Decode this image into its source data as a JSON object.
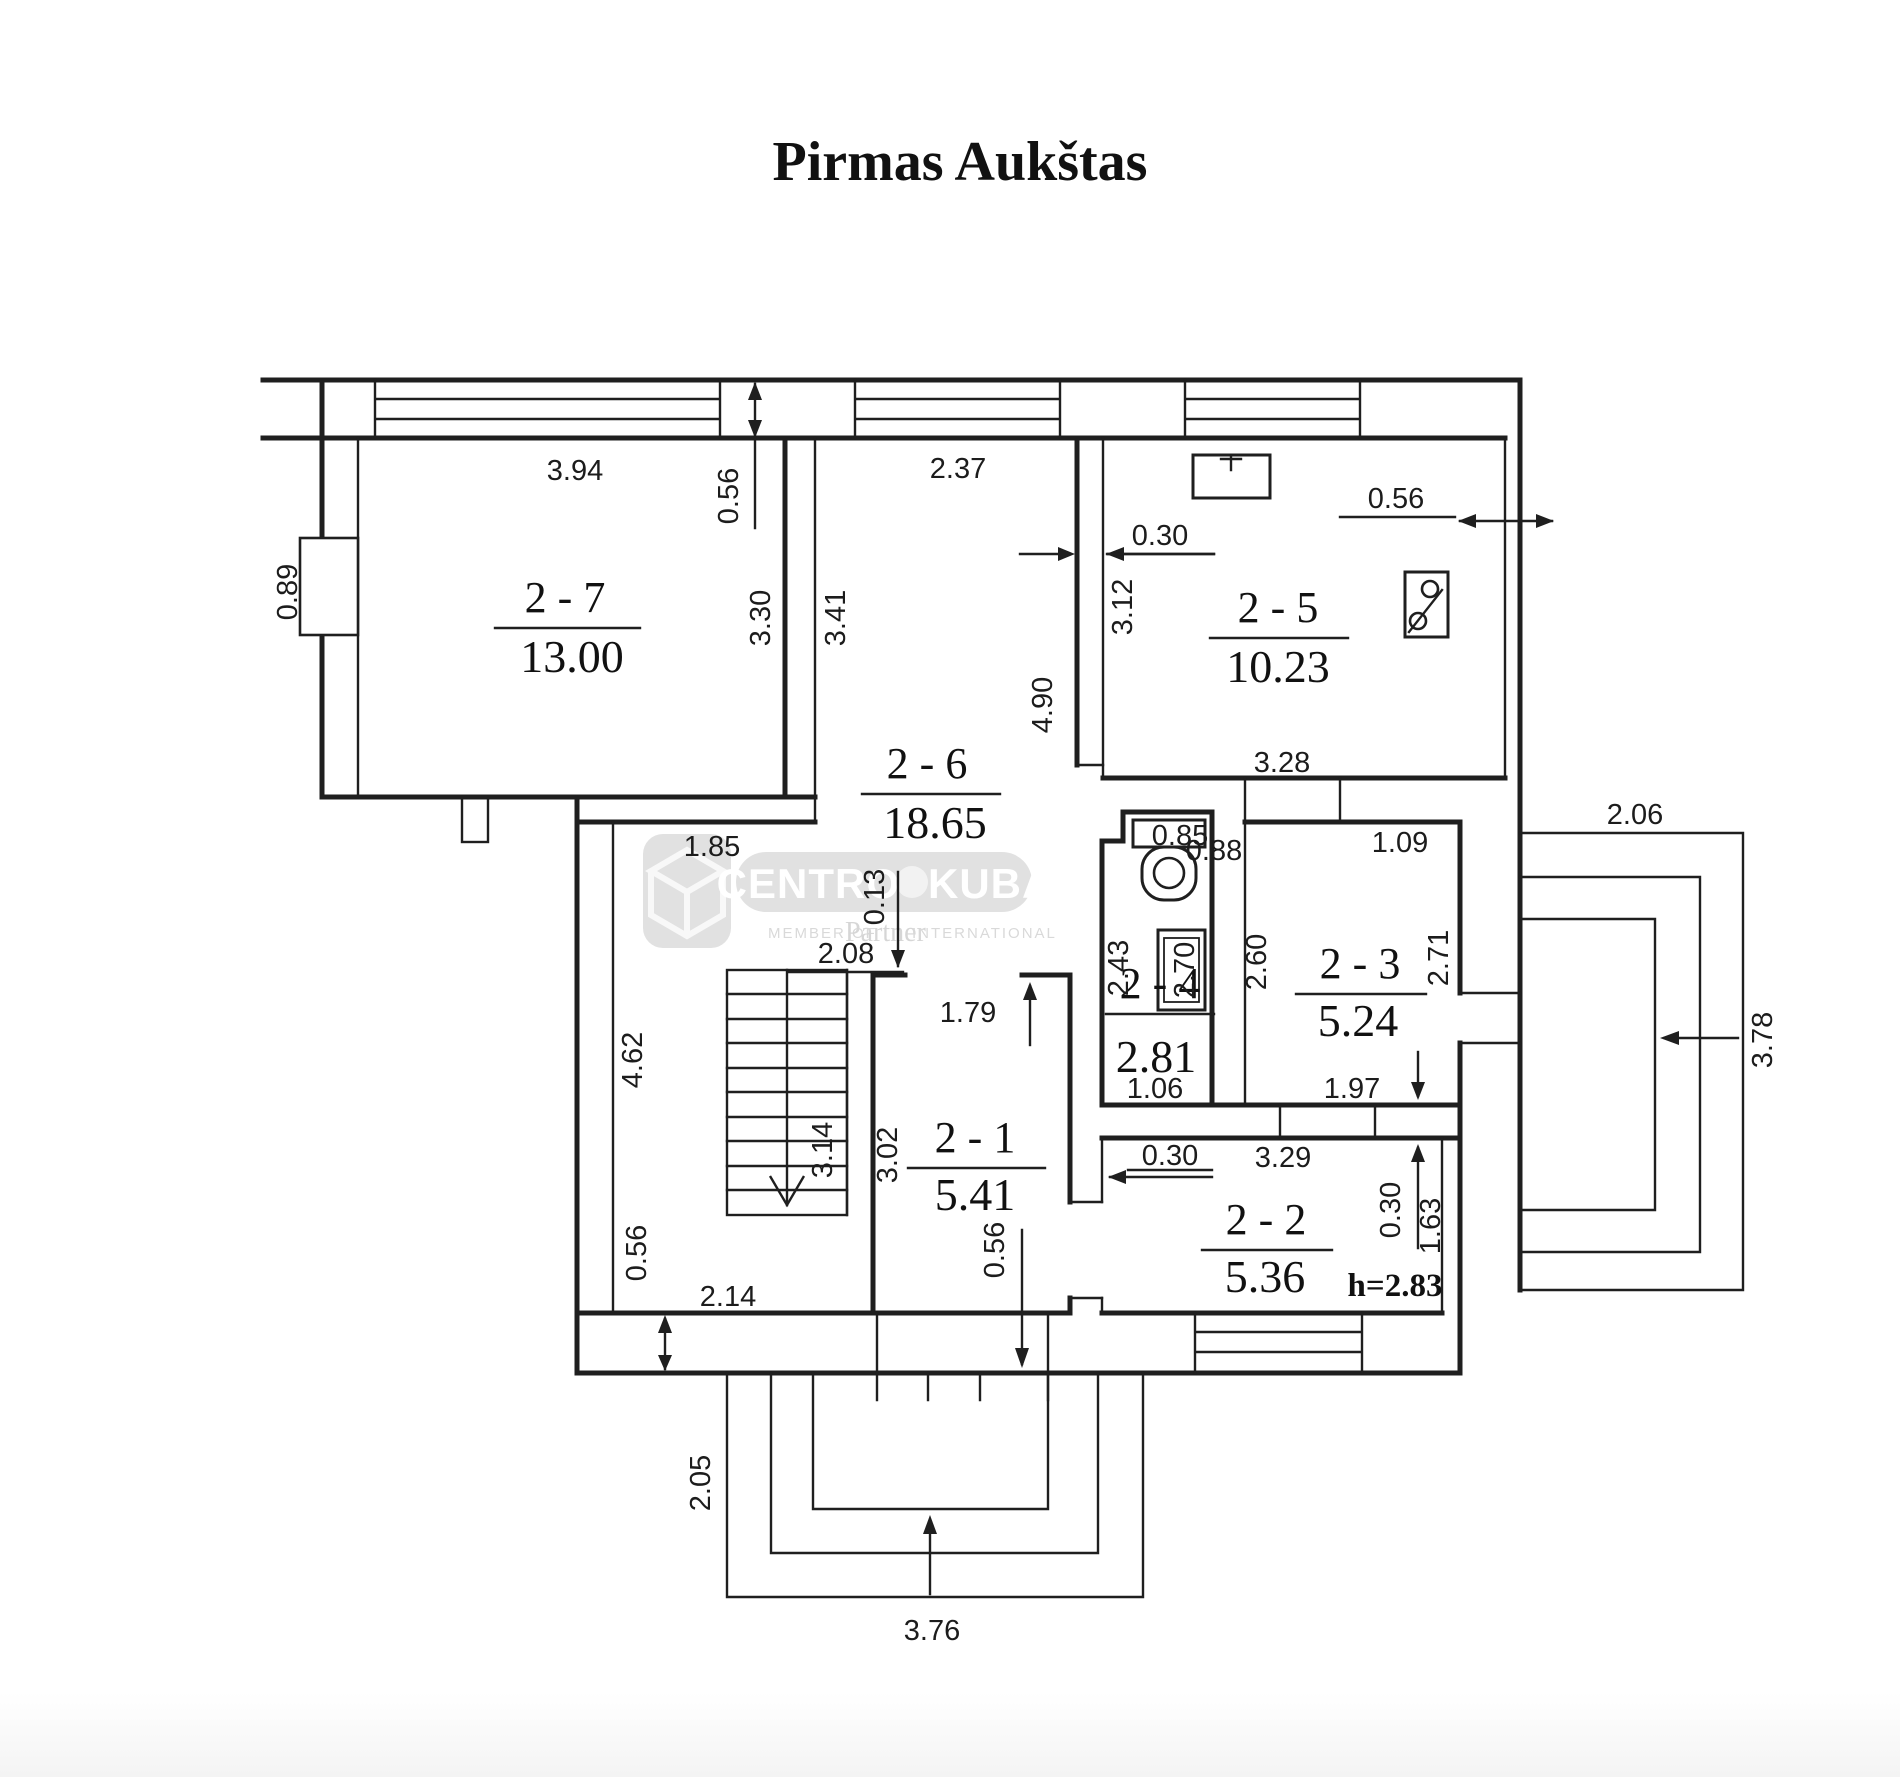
{
  "title": "Pirmas Aukštas",
  "watermark": {
    "brand_left": "CENTRO",
    "brand_right": "KUBAS",
    "member": "MEMBER OF",
    "partner": "Partner",
    "international": "INTERNATIONAL"
  },
  "rooms": {
    "r27": {
      "name": "2 - 7",
      "area": "13.00"
    },
    "r26": {
      "name": "2 - 6",
      "area": "18.65"
    },
    "r25": {
      "name": "2 - 5",
      "area": "10.23"
    },
    "r24": {
      "name": "2 - 4",
      "area": "2.81"
    },
    "r23": {
      "name": "2 - 3",
      "area": "5.24"
    },
    "r22": {
      "name": "2 - 2",
      "area": "5.36"
    },
    "r21": {
      "name": "2 - 1",
      "area": "5.41"
    }
  },
  "dims": {
    "t394": "3.94",
    "t237": "2.37",
    "t056l": "0.56",
    "t330": "3.30",
    "t341": "3.41",
    "t089": "0.89",
    "k030": "0.30",
    "k056": "0.56",
    "k312": "3.12",
    "k490": "4.90",
    "m185": "1.85",
    "m328": "3.28",
    "m206": "2.06",
    "m088": "0.88",
    "m109": "1.09",
    "m085": "0.85",
    "m013": "0.13",
    "m208": "2.08",
    "w243": "2.43",
    "w270": "2.70",
    "w260": "2.60",
    "w271": "2.71",
    "w106": "1.06",
    "w197": "1.97",
    "h462": "4.62",
    "s314": "3.14",
    "r302": "3.02",
    "r179": "1.79",
    "r056": "0.56",
    "h214": "2.14",
    "h056": "0.56",
    "b030": "0.30",
    "b329": "3.29",
    "b030r": "0.30",
    "b163": "1.63",
    "bh": "h=2.83",
    "p205": "2.05",
    "p376": "3.76",
    "ter378": "3.78"
  },
  "colors": {
    "line": "#1f1f1f",
    "watermark_gray": "#d9d9d9"
  }
}
